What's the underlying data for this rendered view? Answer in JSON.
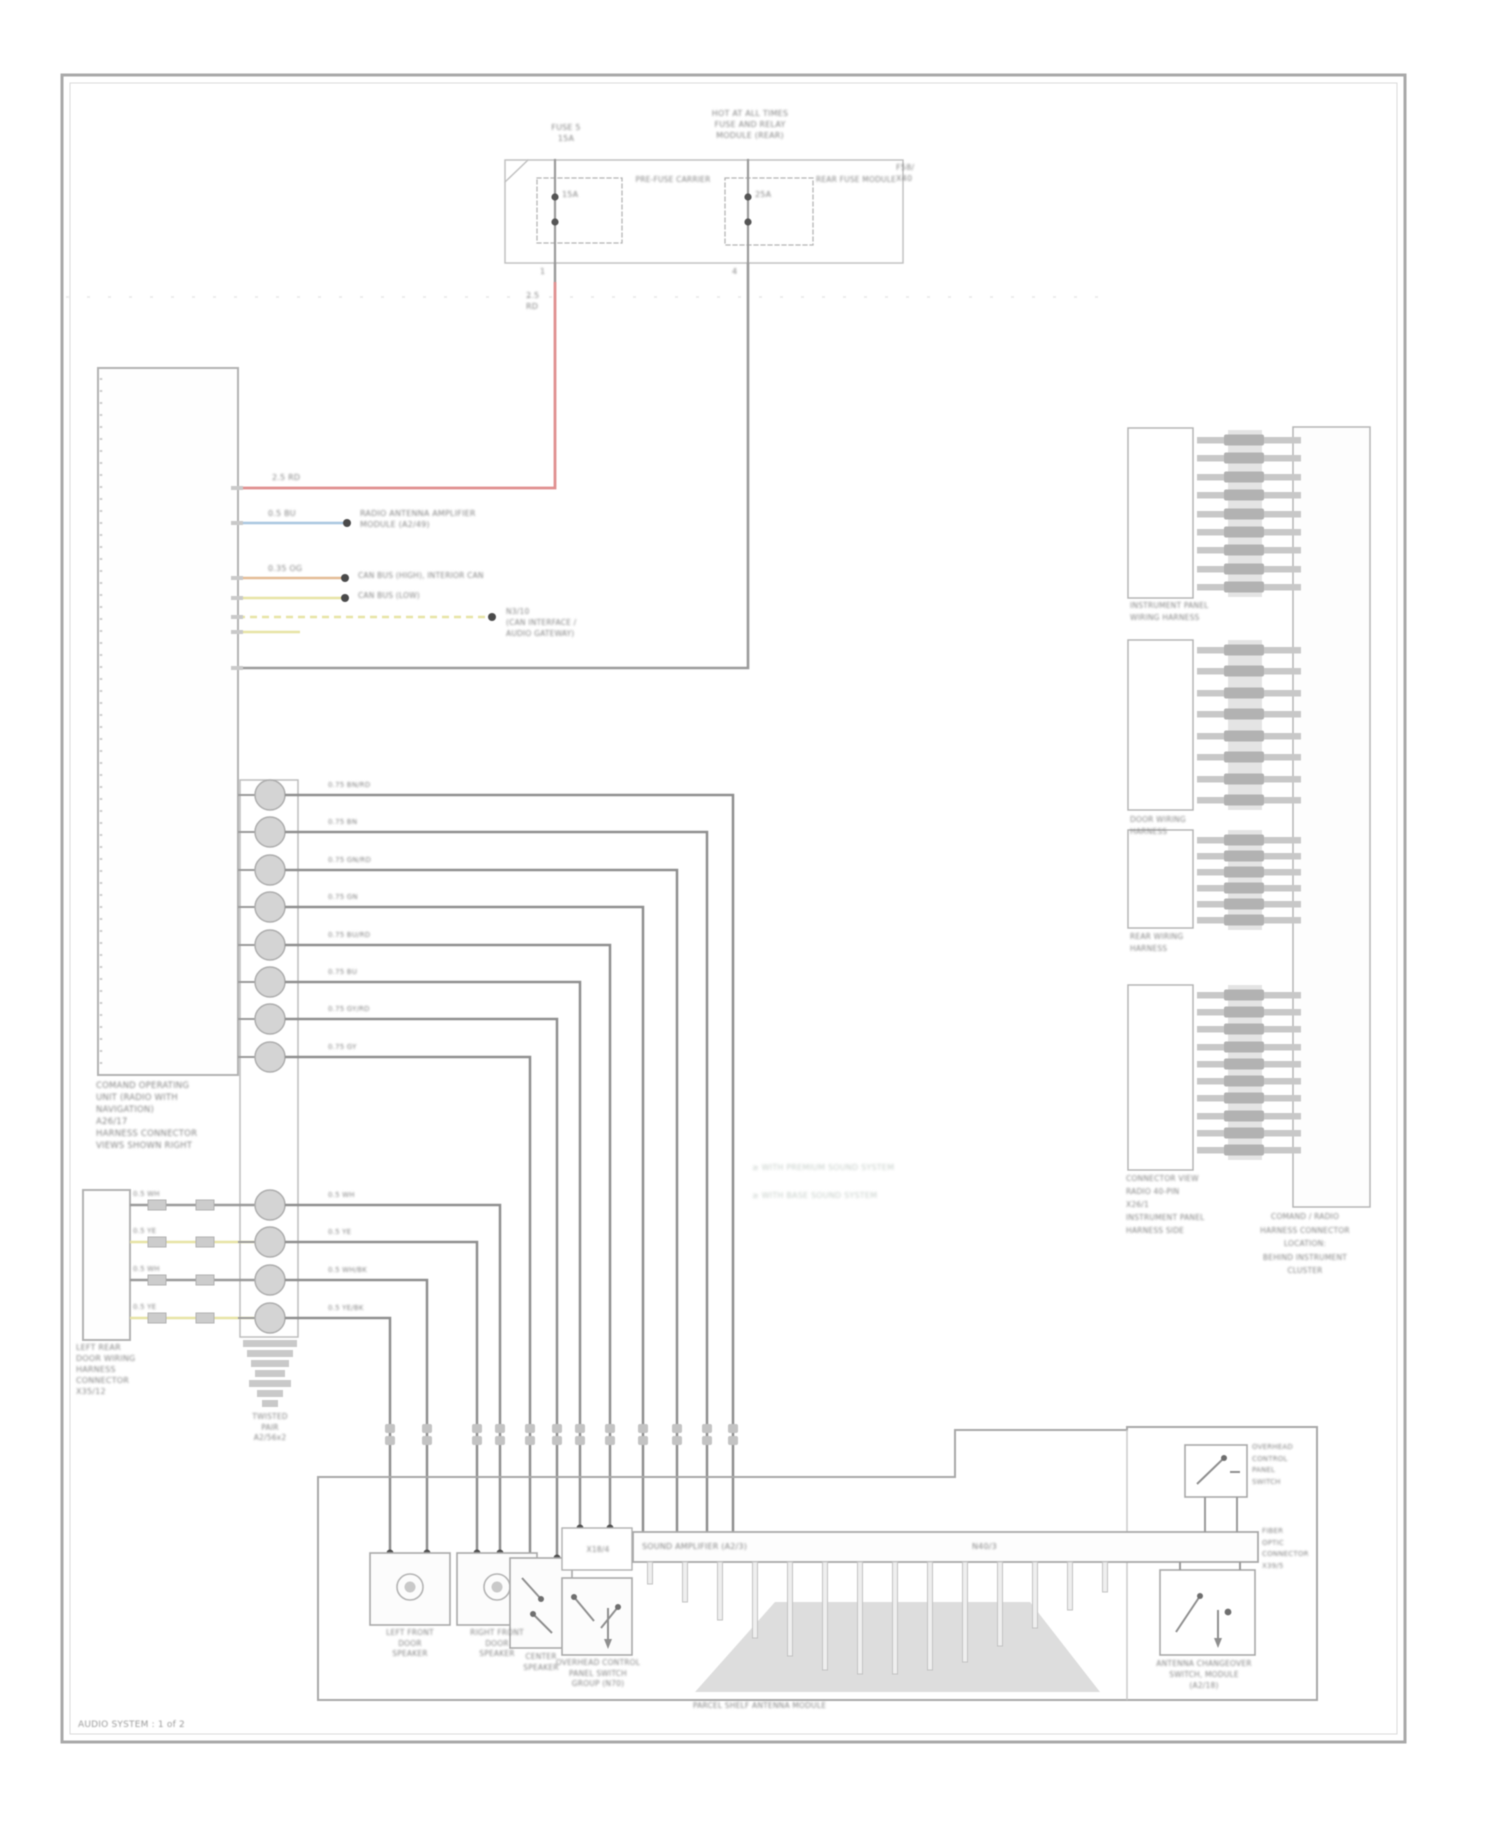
{
  "caption": "AUDIO SYSTEM : 1 of 2",
  "colors": {
    "red": "#e08f8f",
    "blue": "#a9c6e0",
    "orange": "#e3bc95",
    "yellow": "#e7e3a4",
    "line": "#9a9a9a",
    "dark_dot": "#4f4f4f",
    "symbol_fill": "#d4d4d4",
    "border": "#a9a9a9"
  },
  "fusebox": {
    "top_left": "FUSE 5\n15A",
    "top_center": "HOT AT ALL TIMES\nFUSE AND RELAY\nMODULE (REAR)",
    "right_tag": "F58/\nX40",
    "carrier_label": "PRE-FUSE CARRIER",
    "module_label": "REAR FUSE MODULE",
    "fuse1_amps": "15A",
    "fuse2_amps": "25A",
    "fuse1_pin": "1",
    "fuse2_pin": "4",
    "wire1_code": "2.5\nRD"
  },
  "head_unit": {
    "label": "COMAND OPERATING\nUNIT (RADIO WITH\nNAVIGATION)\nA26/17\nHARNESS CONNECTOR\nVIEWS SHOWN RIGHT"
  },
  "wires": {
    "red_label": "2.5 RD",
    "blue_label": "0.5 BU",
    "blue_dest": "RADIO ANTENNA AMPLIFIER\nMODULE (A2/49)",
    "orange_label": "0.35 OG",
    "orange_dest": "CAN BUS (HIGH), INTERIOR CAN",
    "yellow1_dest": "CAN BUS (LOW)",
    "yellow2_dest": "N3/10\n(CAN INTERFACE /\nAUDIO GATEWAY)"
  },
  "wire_labels": {
    "upper": [
      "0.75 BN/RD",
      "0.75 BN",
      "0.75 GN/RD",
      "0.75 GN",
      "0.75 BU/RD",
      "0.75 BU",
      "0.75 GY/RD",
      "0.75 GY"
    ],
    "lower": [
      "0.5 WH",
      "0.5 YE",
      "0.5 WH/BK",
      "0.5 YE/BK"
    ],
    "small_box": [
      "0.5 WH",
      "0.5 YE",
      "0.5 WH",
      "0.5 YE"
    ]
  },
  "small_box": {
    "label": "LEFT REAR\nDOOR WIRING\nHARNESS\nCONNECTOR\nX35/12"
  },
  "twist": {
    "label": "TWISTED\nPAIR\nA2/56x2"
  },
  "bottom": {
    "speaker1_label": "LEFT FRONT\nDOOR\nSPEAKER",
    "speaker2_label": "RIGHT FRONT\nDOOR\nSPEAKER",
    "box3_label": "CENTER\nSPEAKER",
    "box4_label": "OVERHEAD CONTROL\nPANEL SWITCH\nGROUP (N70)",
    "box4_tag": "X18/4",
    "bar_label": "SOUND AMPLIFIER (A2/3)",
    "bar_tag": "N40/3",
    "mound_label": "PARCEL SHELF ANTENNA MODULE",
    "switch1_label": "OVERHEAD\nCONTROL\nPANEL\nSWITCH",
    "bar_end_label": "FIBER\nOPTIC\nCONNECTOR\nX39/5",
    "switch2_label": "ANTENNA CHANGEOVER\nSWITCH, MODULE\n(A2/18)"
  },
  "right_panel": {
    "b1": "INSTRUMENT PANEL\nWIRING HARNESS",
    "b2": "DOOR WIRING\nHARNESS",
    "b3": "REAR WIRING\nHARNESS",
    "b4": "CONNECTOR VIEW\nRADIO 40-PIN\nX26/1\nINSTRUMENT PANEL\nHARNESS SIDE",
    "tall": "COMAND / RADIO\nHARNESS CONNECTOR\nLOCATION:\nBEHIND INSTRUMENT\nCLUSTER"
  },
  "notes": "≥ WITH PREMIUM SOUND SYSTEM\n≥ WITH BASE SOUND SYSTEM"
}
